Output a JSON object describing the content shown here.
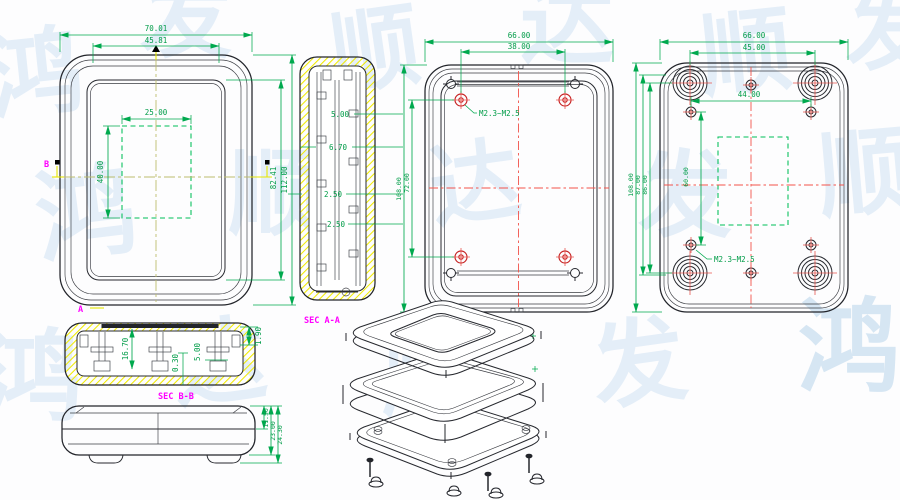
{
  "watermark_chars": [
    "鸿",
    "发",
    "顺",
    "达",
    "顺",
    "发",
    "鸿",
    "顺",
    "达",
    "发",
    "顺",
    "鸿",
    "达",
    "顺",
    "发",
    "鸿"
  ],
  "front": {
    "w_outer": "70.01",
    "w_inner": "45.81",
    "win_w": "25.00",
    "win_h": "40.00",
    "h_inner": "82.41",
    "h_outer": "112.00",
    "sec_a": "A",
    "sec_b": "B"
  },
  "sec_aa": {
    "label": "SEC A-A",
    "d_top": "5.00",
    "d_rib": "6.70",
    "d_wall1": "2.50",
    "d_wall2": "2.50"
  },
  "back_inner": {
    "w_outer": "66.00",
    "w_holes": "38.00",
    "h_outer": "108.00",
    "h_holes": "72.00",
    "thread": "M2.3~M2.5"
  },
  "back_outer": {
    "w_outer": "66.00",
    "w_feet": "45.00",
    "w_mid": "44.00",
    "h_outer": "108.00",
    "h_a": "87.00",
    "h_b": "86.00",
    "h_mid": "60.00",
    "thread": "M2.3~M2.5"
  },
  "sec_bb": {
    "label": "SEC B-B",
    "d_depth": "16.70",
    "d_gap": "0.30",
    "d_boss": "5.00",
    "d_lip": "1.90"
  },
  "side": {
    "d_half": "11.50",
    "d_body": "23.00",
    "d_total": "24.30"
  }
}
